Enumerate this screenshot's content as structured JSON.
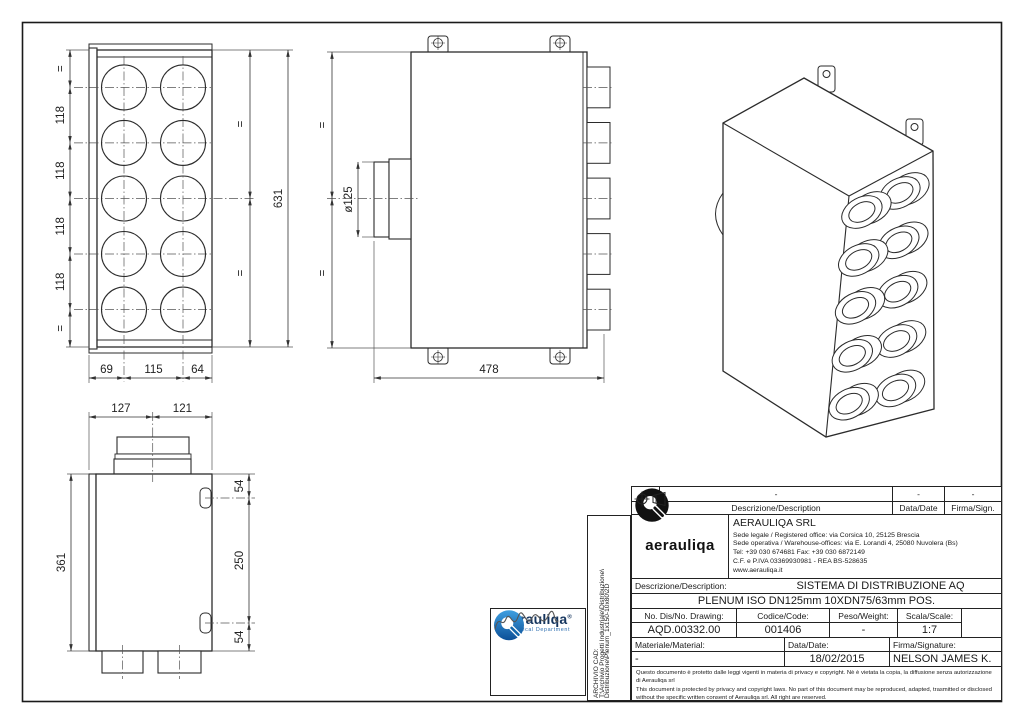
{
  "views": {
    "front": {
      "left_chain": [
        "=",
        "118",
        "118",
        "118",
        "118",
        "="
      ],
      "right_chain": [
        "=",
        "="
      ],
      "right_total": "631",
      "bottom": [
        "69",
        "115",
        "64"
      ]
    },
    "top": {
      "left_chain": [
        "=",
        "="
      ],
      "diameter": "ø125",
      "bottom": "478"
    },
    "side": {
      "top": [
        "127",
        "121"
      ],
      "left": "361",
      "right": [
        "54",
        "250",
        "54"
      ]
    }
  },
  "title_block": {
    "revision": {
      "rev_value": "-",
      "desc_value": "-",
      "date_value": "-",
      "sign_value": "-",
      "rev_label": "Rev.",
      "desc_label": "Descrizione/Description",
      "date_label": "Data/Date",
      "sign_label": "Firma/Sign."
    },
    "company": {
      "name": "AERAULIQA SRL",
      "lines": [
        "Sede legale / Registered office: via Corsica 10, 25125 Brescia",
        "Sede operativa / Warehouse-offices: via E. Lorandi 4, 25080 Nuvolera (Bs)",
        "Tel: +39 030 674681 Fax: +39 030 6872149",
        "C.F. e P.IVA 03369930981 - REA BS-528635",
        "www.aerauliqa.it"
      ],
      "logo_text": "aerauliqa"
    },
    "description": {
      "label": "Descrizione/Description:",
      "line1": "SISTEMA DI DISTRIBUZIONE AQ",
      "line2": "PLENUM ISO DN125mm 10XDN75/63mm POS."
    },
    "fields": {
      "drawing_label": "No. Dis/No. Drawing:",
      "drawing_value": "AQD.00332.00",
      "code_label": "Codice/Code:",
      "code_value": "001406",
      "weight_label": "Peso/Weight:",
      "weight_value": "-",
      "scale_label": "Scala/Scale:",
      "scale_value": "1:7",
      "material_label": "Materiale/Material:",
      "material_value": "-",
      "date_label": "Data/Date:",
      "date_value": "18/02/2015",
      "signature_label": "Firma/Signature:",
      "signature_value": "NELSON JAMES K."
    },
    "legal": {
      "line1": "Questo documento è protetto dalle leggi vigenti in materia di privacy e copyright. Nè è vietata la copia, la diffusione senza autorizzazione di Aerauliqa srl",
      "line2": "This document is protected by privacy and copyright laws. No part of this document may be reproduced, adapted, trasmitted or disclosed without the specific written consent of Aerauliqa srl. All right are reserved."
    }
  },
  "archive": {
    "line1": "ARCHIVIO CAD:",
    "line2": "T:\\Archivio Progetti Industriale\\Distribuzione\\",
    "line3": "Distribuzione\\Plenum_1x150-10x80\\2D"
  },
  "stamp": {
    "brand": "aerauliqa",
    "registered": "®",
    "department": "Technical Department"
  },
  "colors": {
    "line": "#2b2b2b",
    "brand_blue": "#1266ab",
    "brand_navy": "#15355e"
  }
}
